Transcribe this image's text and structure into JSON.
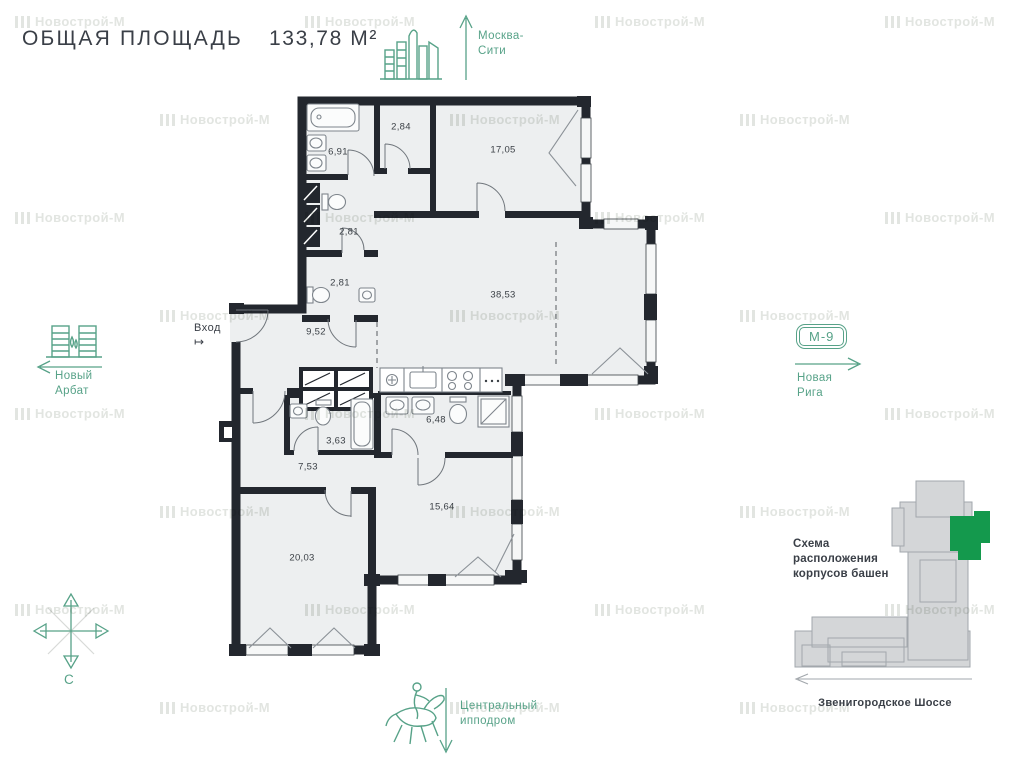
{
  "title": {
    "label": "ОБЩАЯ ПЛОЩАДЬ",
    "value": "133,78 М²"
  },
  "watermark": {
    "text": "Новострой-М"
  },
  "colors": {
    "green": "#57a288",
    "bright_green": "#14994d",
    "dark": "#3a3f47",
    "wall": "#23272e",
    "room_fill": "#edeff0",
    "scheme_gray": "#d4d6d8"
  },
  "directions": {
    "north_city": {
      "line1": "Москва-",
      "line2": "Сити"
    },
    "west": {
      "line1": "Новый",
      "line2": "Арбат"
    },
    "east": {
      "badge": "М-9",
      "line1": "Новая",
      "line2": "Рига"
    },
    "south": {
      "line1": "Центральный",
      "line2": "ипподром"
    },
    "compass": {
      "label": "С"
    }
  },
  "plan": {
    "entrance": {
      "label": "Вход",
      "symbol": "↦"
    },
    "rooms": [
      {
        "name": "bathroom-1",
        "area": "6,91"
      },
      {
        "name": "wardrobe",
        "area": "2,84"
      },
      {
        "name": "bedroom-1",
        "area": "17,05"
      },
      {
        "name": "wc-1",
        "area": "2,81"
      },
      {
        "name": "wc-2",
        "area": "2,81"
      },
      {
        "name": "living-kitchen",
        "area": "38,53"
      },
      {
        "name": "hall",
        "area": "9,52"
      },
      {
        "name": "bathroom-2",
        "area": "3,63"
      },
      {
        "name": "bathroom-3",
        "area": "6,48"
      },
      {
        "name": "corridor",
        "area": "7,53"
      },
      {
        "name": "bedroom-2",
        "area": "15,64"
      },
      {
        "name": "bedroom-3",
        "area": "20,03"
      }
    ]
  },
  "scheme": {
    "line1": "Схема",
    "line2": "расположения",
    "line3": "корпусов башен",
    "road": "Звенигородское Шоссе"
  }
}
